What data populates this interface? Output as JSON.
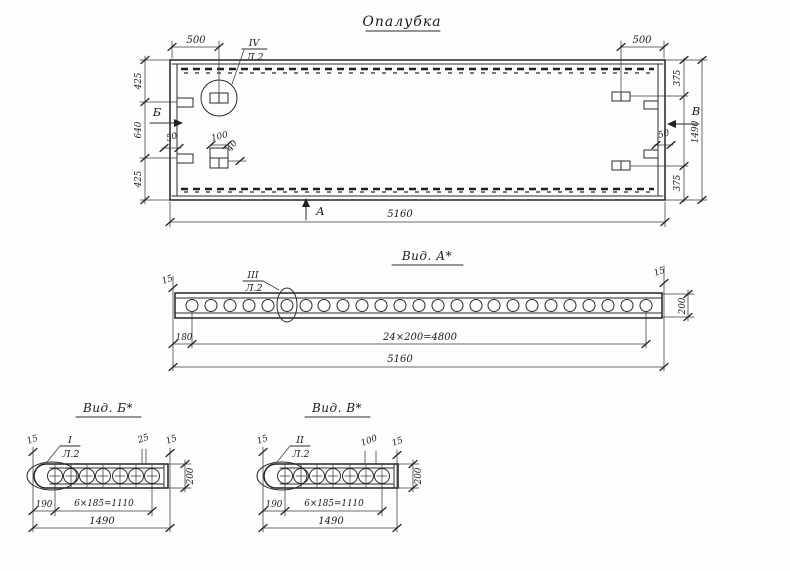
{
  "colors": {
    "ink": "#232323",
    "paper": "#fdfdfc"
  },
  "title": "Опалубка",
  "plan": {
    "dim_500_left": "500",
    "dim_500_right": "500",
    "dim_425_top": "425",
    "dim_640": "640",
    "dim_425_bottom": "425",
    "dim_375_top": "375",
    "dim_375_bottom": "375",
    "dim_1490": "1490",
    "dim_50_left": "50",
    "dim_50_right": "50",
    "dim_5160": "5160",
    "detail_dim_100": "100",
    "detail_dim_40": "40",
    "callout_num": "IV",
    "callout_sheet": "Л.2",
    "arrow_a": "А",
    "arrow_b": "Б",
    "arrow_v": "В"
  },
  "view_a": {
    "title": "Вид. А*",
    "callout_num": "III",
    "callout_sheet": "Л.2",
    "dim_15_left": "15",
    "dim_15_right": "15",
    "dim_200": "200",
    "dim_180": "180",
    "dim_spacing": "24×200=4800",
    "dim_total": "5160"
  },
  "view_b": {
    "title": "Вид. Б*",
    "callout_num": "I",
    "callout_sheet": "Л.2",
    "dim_15_left": "15",
    "dim_25": "25",
    "dim_15_right": "15",
    "dim_200": "200",
    "dim_190": "190",
    "dim_spacing": "6×185=1110",
    "dim_total": "1490"
  },
  "view_v": {
    "title": "Вид. В*",
    "callout_num": "II",
    "callout_sheet": "Л.2",
    "dim_15_left": "15",
    "dim_100": "100",
    "dim_15_right": "15",
    "dim_200": "200",
    "dim_190": "190",
    "dim_spacing": "6×185=1110",
    "dim_total": "1490"
  }
}
